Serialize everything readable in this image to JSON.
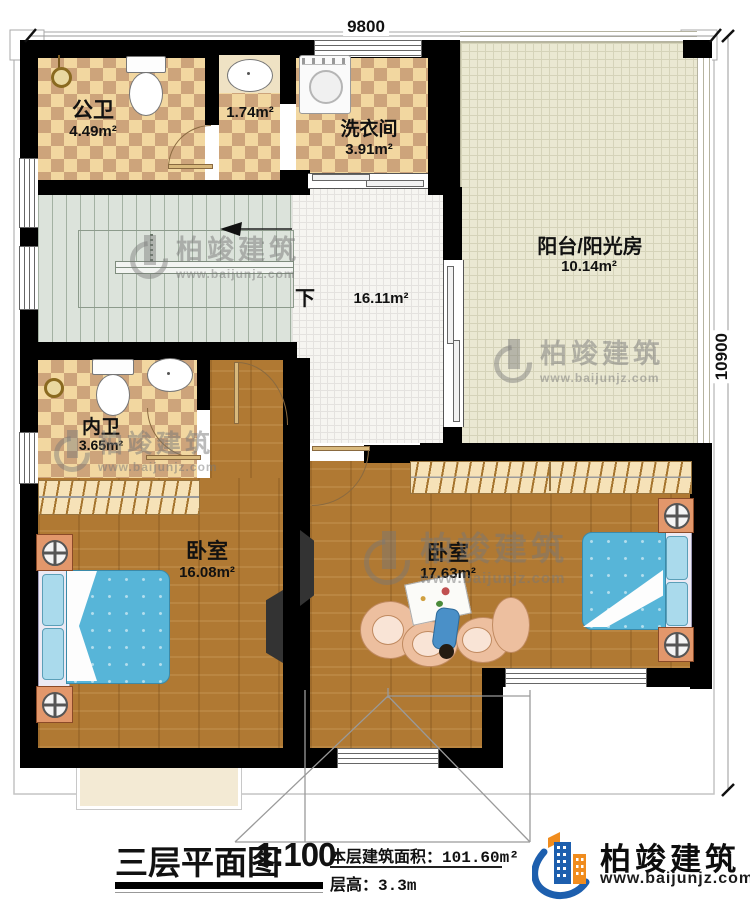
{
  "plan": {
    "dimensions": {
      "top": "9800",
      "right": "10900"
    },
    "stairs": {
      "down_label": "下"
    },
    "rooms": {
      "gongwei": {
        "name": "公卫",
        "area": "4.49m²"
      },
      "corridor": {
        "area": "1.74m²"
      },
      "laundry": {
        "name": "洗衣间",
        "area": "3.91m²"
      },
      "sunroom": {
        "name": "阳台/阳光房",
        "area": "10.14m²"
      },
      "hall": {
        "area": "16.11m²"
      },
      "neiwei": {
        "name": "内卫",
        "area": "3.65m²"
      },
      "bedroom1": {
        "name": "卧室",
        "area": "16.08m²"
      },
      "bedroom2": {
        "name": "卧室",
        "area": "17.63m²"
      }
    }
  },
  "titleblock": {
    "title": "三层平面图",
    "scale": "1:100",
    "area_label": "本层建筑面积：",
    "area_value": "101.60m²",
    "height_label": "层高：",
    "height_value": "3.3m"
  },
  "brand": {
    "name": "柏竣建筑",
    "url": "www.baijunjz.com"
  },
  "watermark": {
    "name": "柏竣建筑",
    "url": "www.baijunjz.com"
  },
  "colors": {
    "wall": "#000000",
    "tile_checker": "#f2d7a0",
    "tile_checker_dark": "#cda47b",
    "sunroom_tile": "#eae8d2",
    "wood_floor": "#b07933",
    "bed_blue": "#57b5d8",
    "nightstand_orange": "#e2976b",
    "logo_blue": "#1d5fae",
    "logo_orange": "#f08c1e"
  }
}
